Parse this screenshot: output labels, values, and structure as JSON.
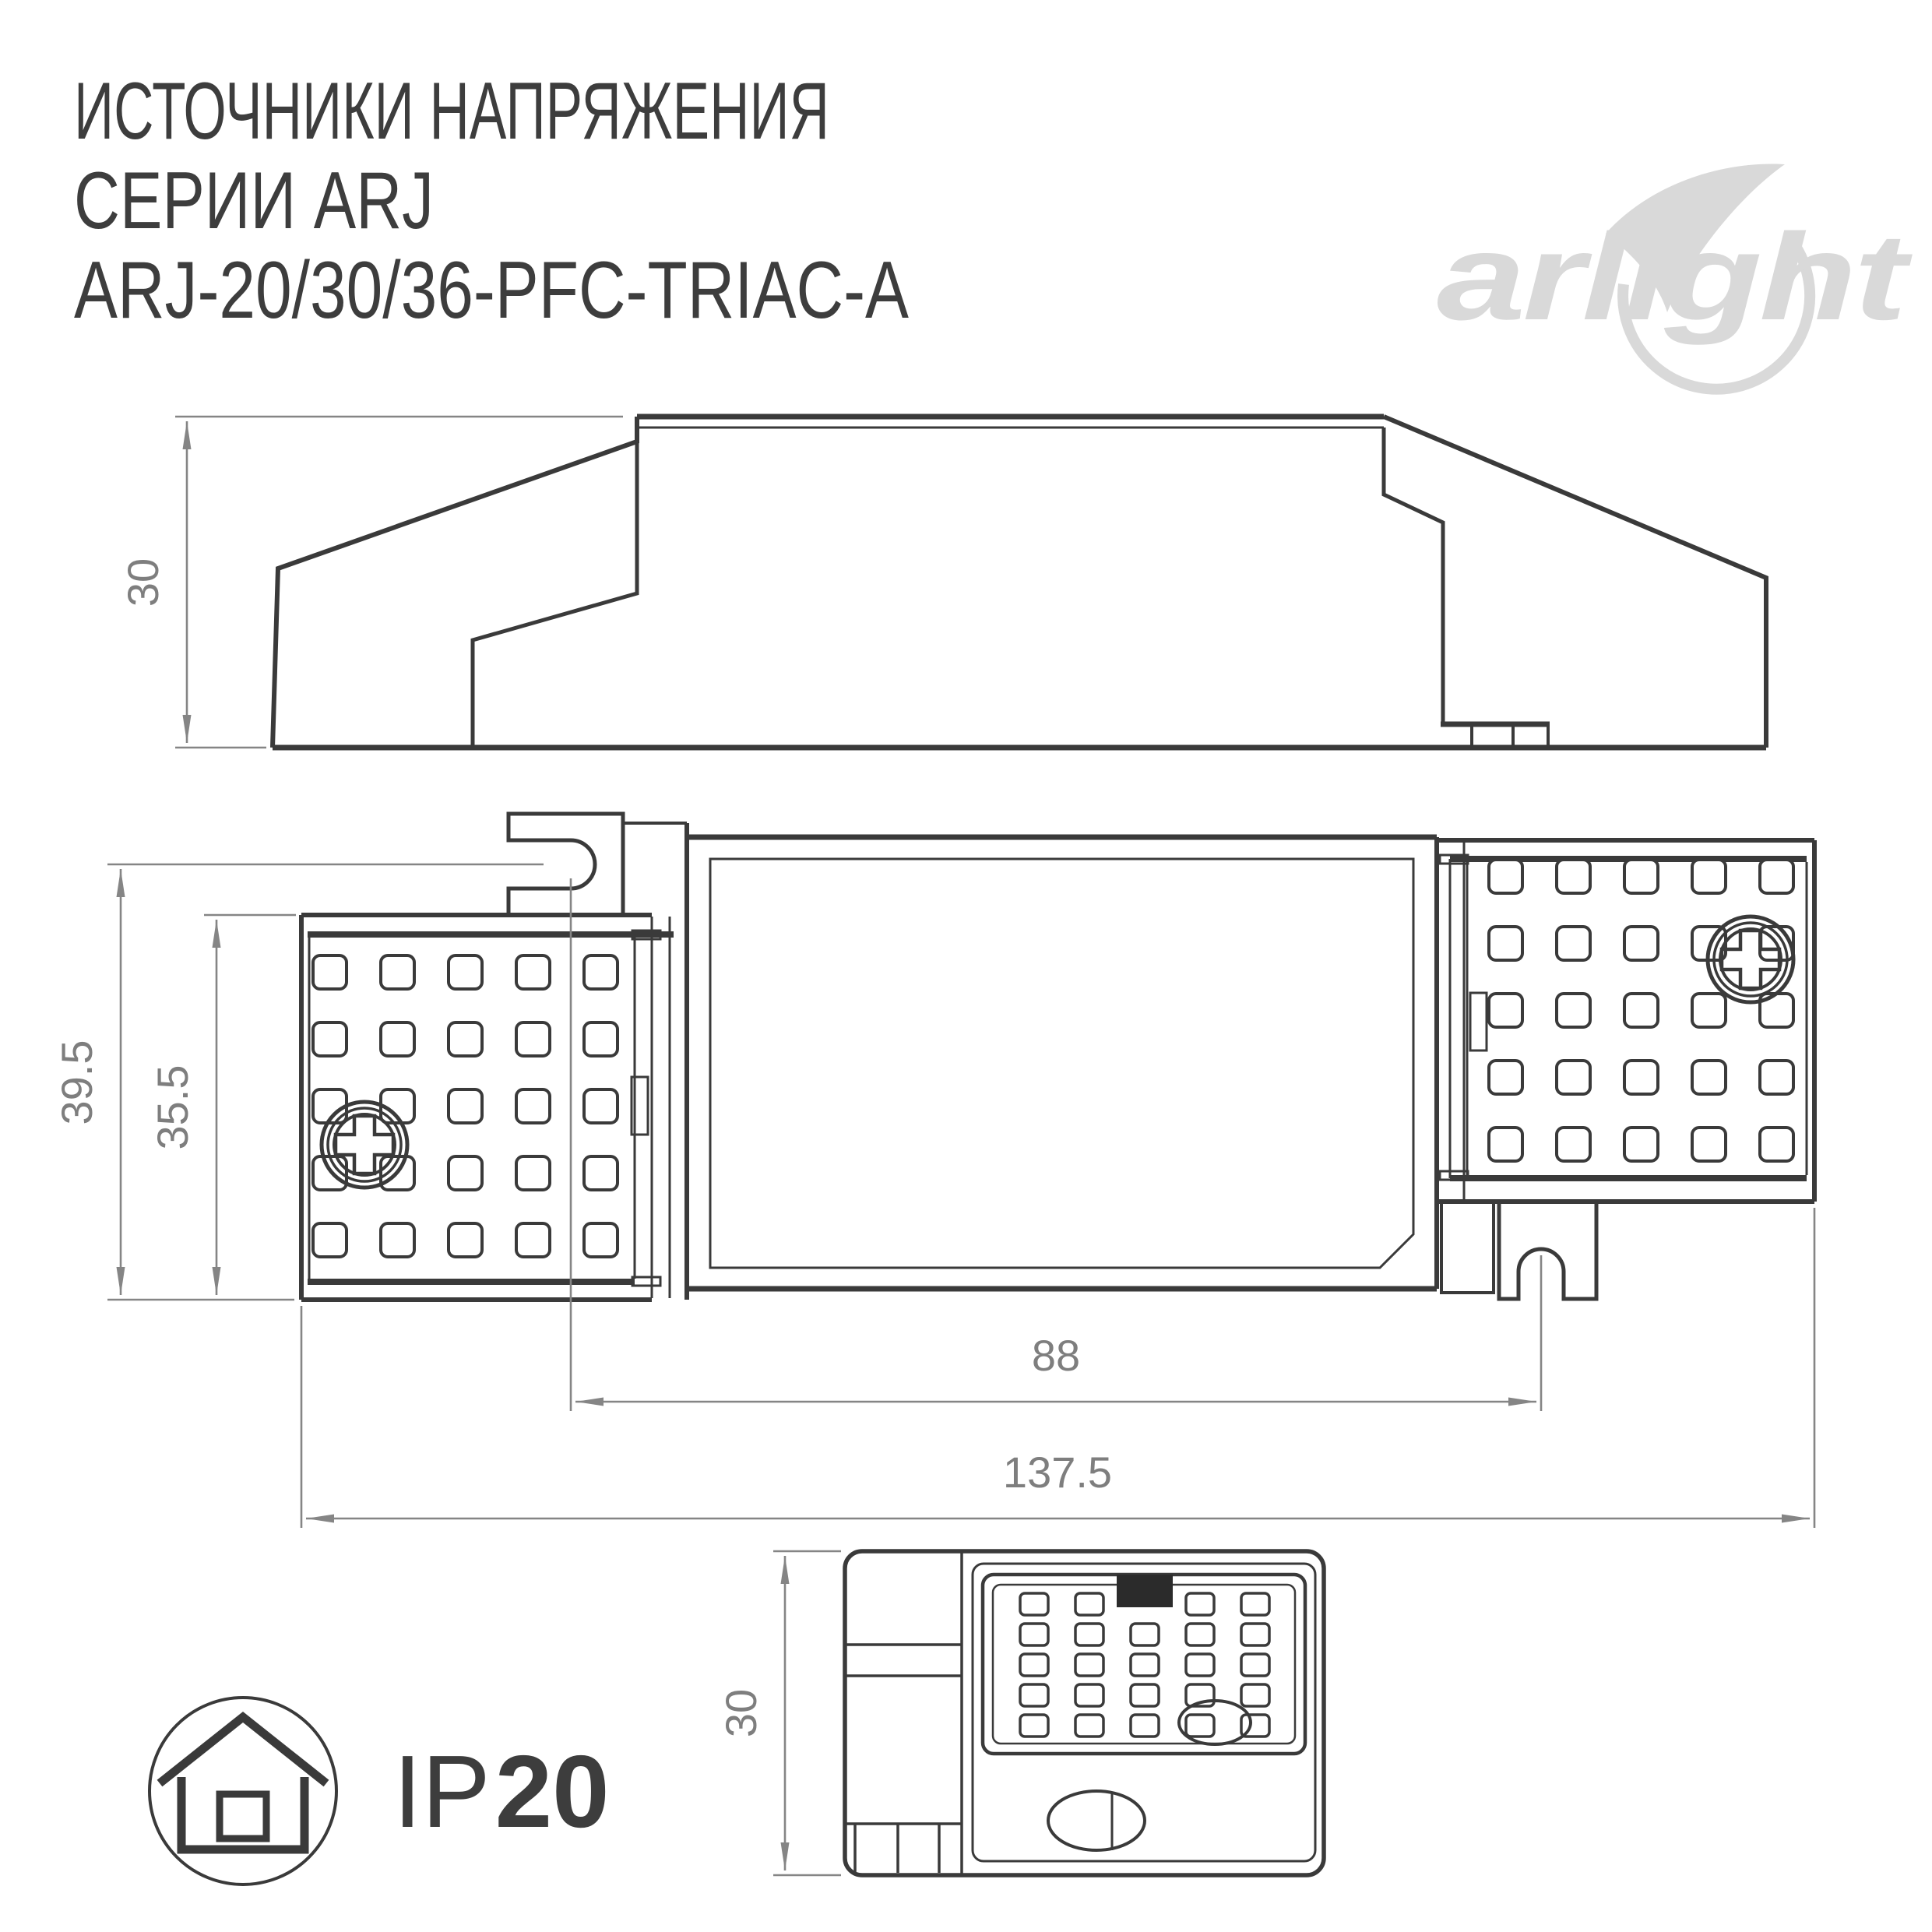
{
  "header": {
    "title_lines": [
      "ИСТОЧНИКИ НАПРЯЖЕНИЯ",
      "СЕРИИ ARJ",
      "ARJ-20/30/36-PFC-TRIAC-A"
    ]
  },
  "logo": {
    "brand": "arlight"
  },
  "dims": {
    "side_height": "30",
    "plan_outer_height": "39.5",
    "plan_inner_height": "35.5",
    "slot_pitch": "88",
    "total_length": "137.5",
    "end_height": "30"
  },
  "ip": {
    "prefix": "IP",
    "value": "20"
  },
  "colors": {
    "line": "#3a3a3a",
    "dimension": "#858585",
    "logo": "#d9d9d9"
  }
}
